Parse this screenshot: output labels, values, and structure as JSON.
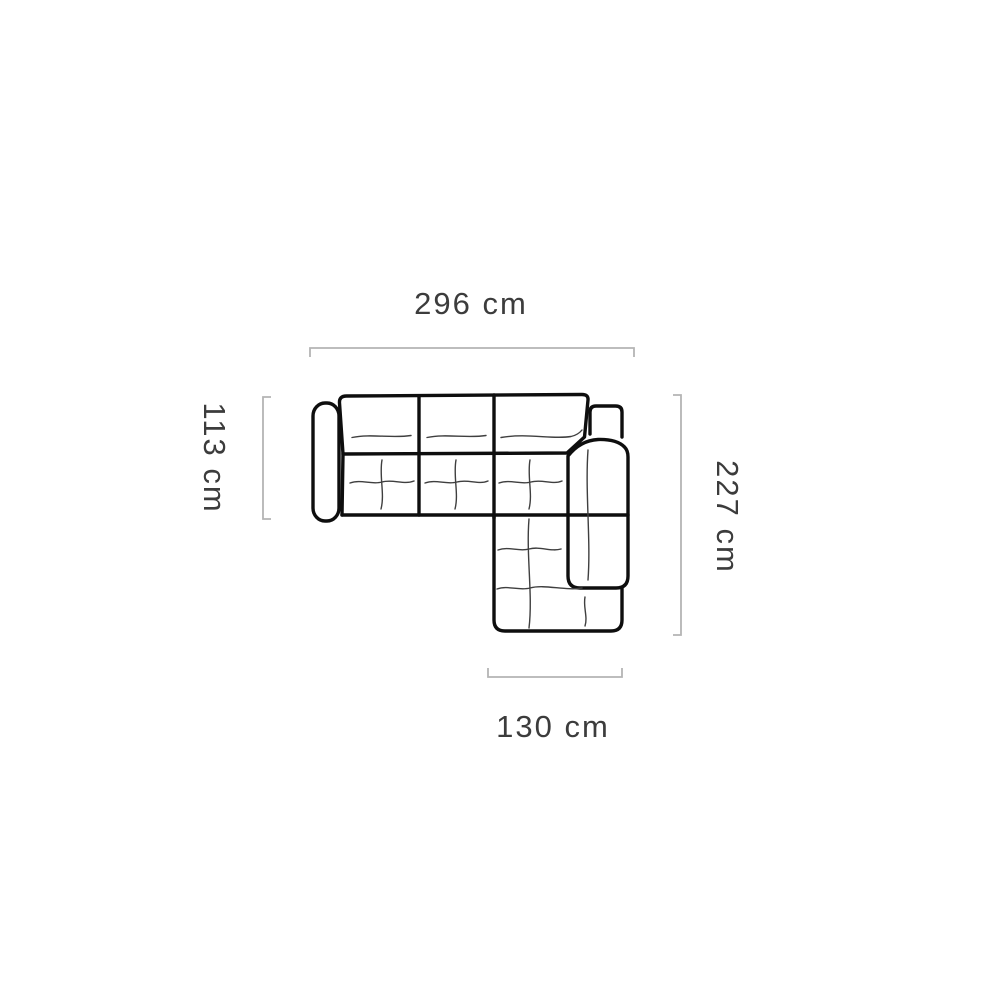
{
  "diagram": {
    "subject": "corner sofa with chaise - top view dimension drawing",
    "labels": {
      "width_top": "296 cm",
      "depth_left": "113 cm",
      "height_right": "227 cm",
      "chaise_bottom": "130 cm"
    },
    "colors": {
      "outline": "#0e0e0e",
      "tuft": "#3f3f3f",
      "dimline": "#b4b4b4",
      "text": "#3c3c3c",
      "bg": "#ffffff"
    }
  }
}
